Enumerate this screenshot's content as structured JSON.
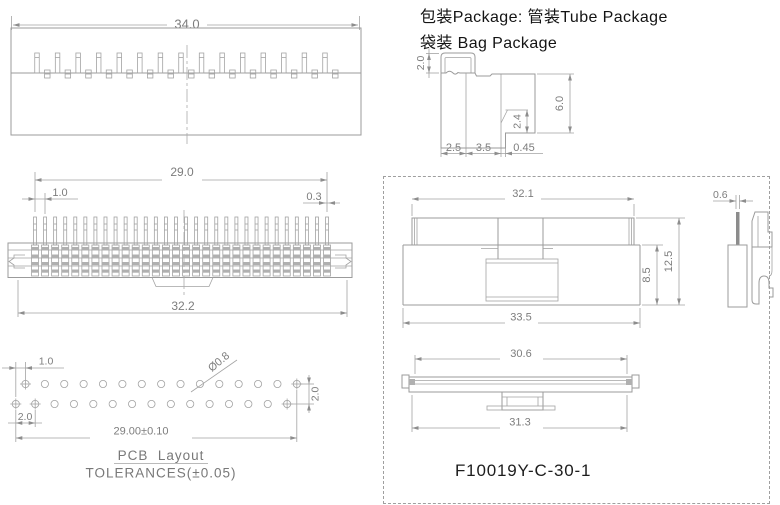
{
  "header": {
    "package_line1": "包装Package: 管装Tube Package",
    "package_line2": "袋装 Bag Package"
  },
  "part_number": "F10019Y-C-30-1",
  "top_view": {
    "overall": "34.0",
    "tall_pin_count": 15,
    "nub_count": 15
  },
  "front_view": {
    "overall_span": "29.0",
    "pitch": "1.0",
    "pin_width": "0.3",
    "body_width": "32.2",
    "pin_count": 30
  },
  "pcb_view": {
    "offset": "1.0",
    "hole_diameter": "Ø0.8",
    "row_spacing": "2.0",
    "pitch": "2.0",
    "span": "29.00±0.10",
    "caption": "PCB  Layout",
    "tolerance": "TOLERANCES(±0.05)",
    "holes_per_row": 15
  },
  "package_view": {
    "lead": "2.0",
    "height": "6.0",
    "tip": "2.4",
    "width_a": "2.5",
    "width_b": "3.5",
    "pin": "0.45"
  },
  "tube_view": {
    "top_width": "32.1",
    "height": "12.5",
    "body_height": "8.5",
    "bottom_width": "33.5"
  },
  "contact_view": {
    "pin_width": "0.6"
  },
  "bottom_view": {
    "inner_width": "30.6",
    "outer_width": "31.3"
  },
  "colors": {
    "line": "#9b9b9b",
    "dim_text": "#7d7d7d",
    "main_text": "#1d1d1d"
  }
}
